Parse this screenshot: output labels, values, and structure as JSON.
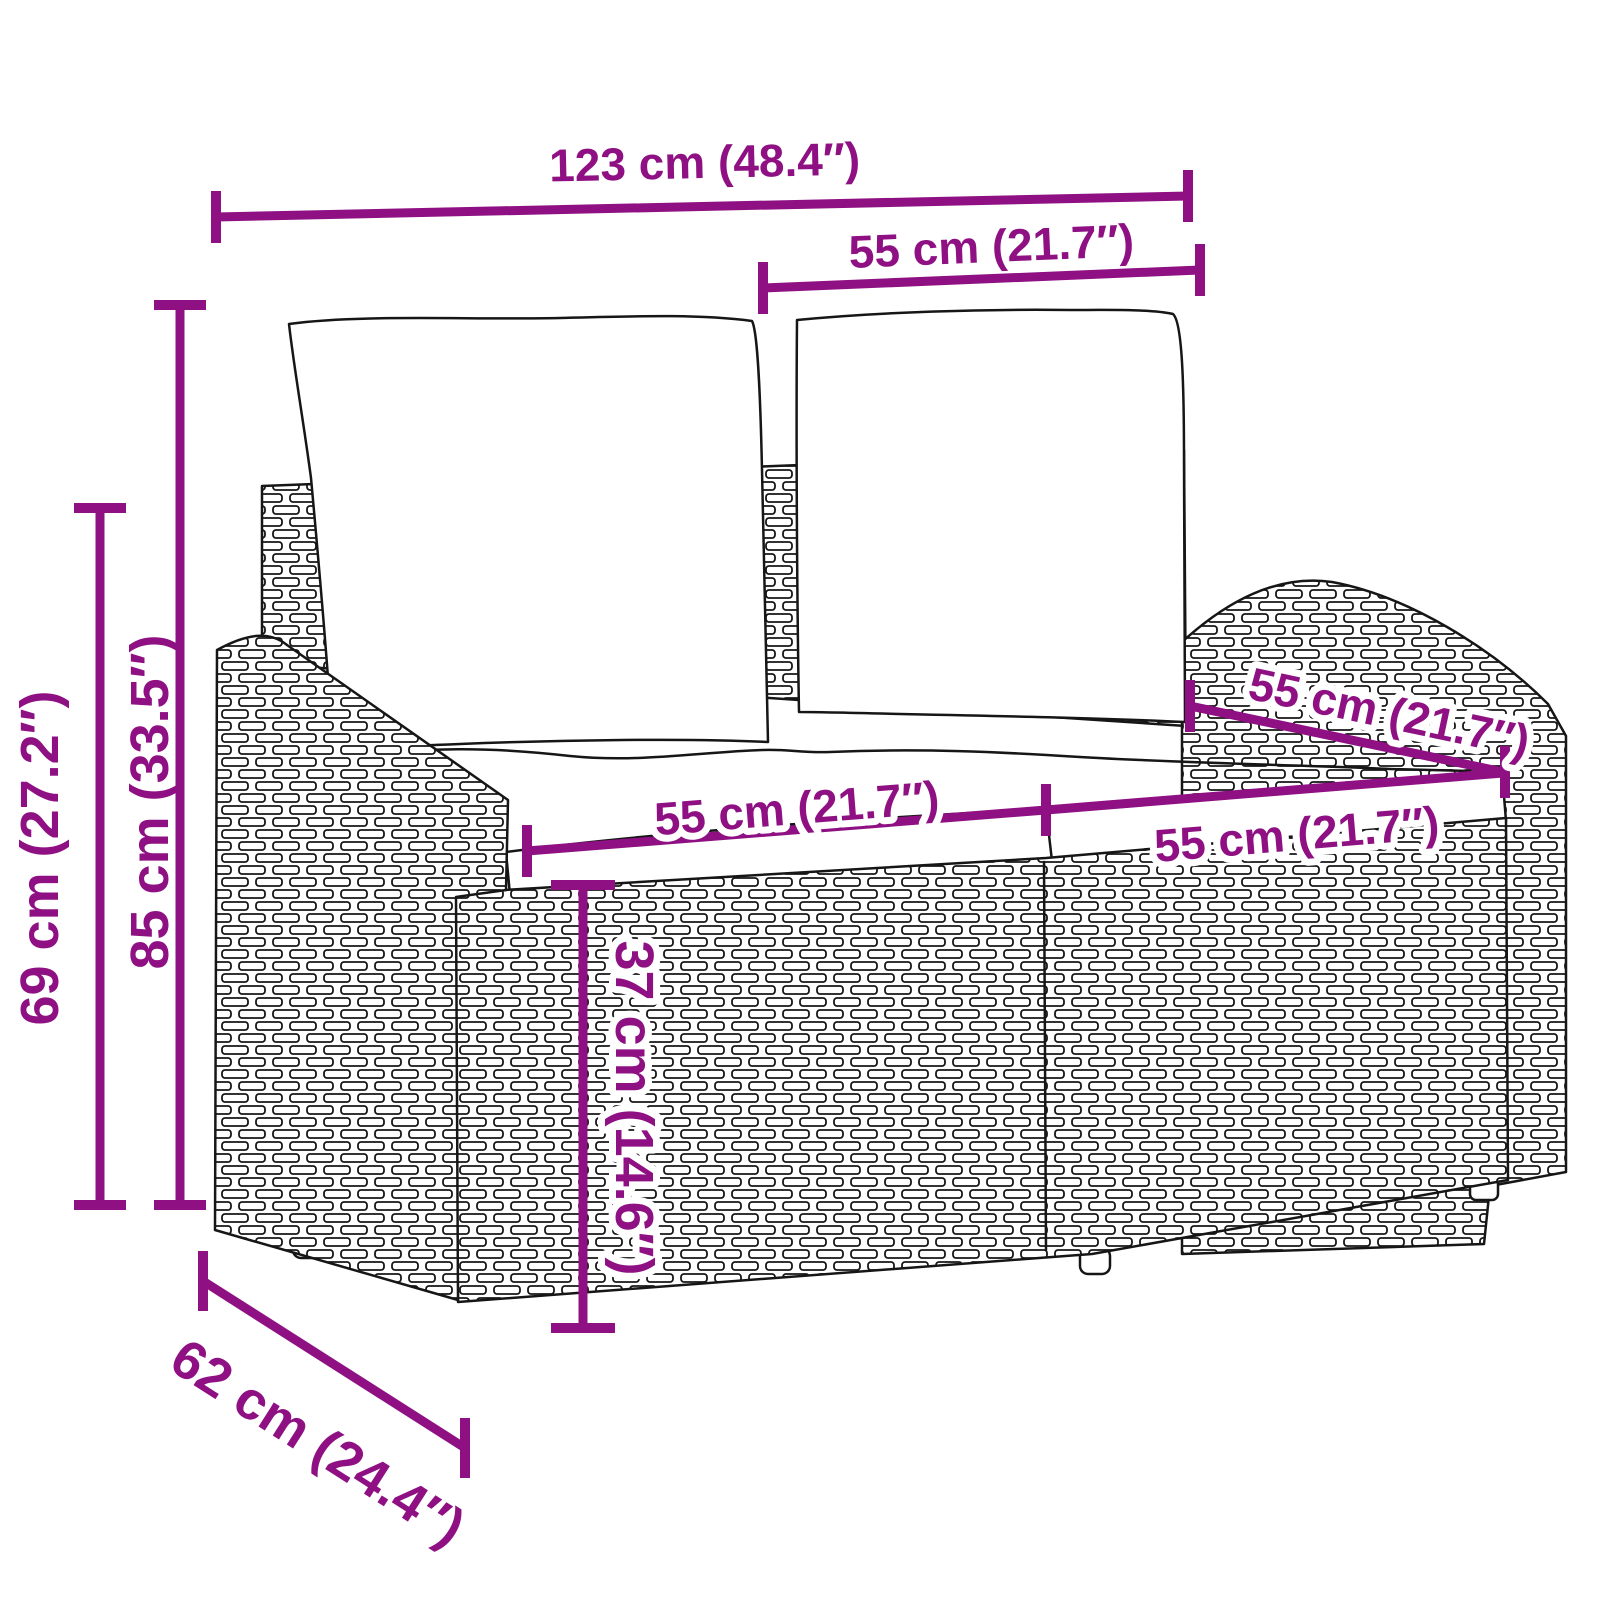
{
  "diagram": {
    "kind": "furniture dimension diagram",
    "subject": "rattan 2-seater garden bench with back and seat cushions"
  },
  "style": {
    "dimension_color": "#8E1083",
    "artwork_line_color": "#161616",
    "background": "#FFFFFF"
  },
  "dims": {
    "overall_width": {
      "label": "123 cm (48.4″)",
      "value_cm": 123,
      "value_inch": 48.4
    },
    "back_width": {
      "label": "55 cm (21.7″)",
      "value_cm": 55,
      "value_inch": 21.7
    },
    "height_outer": {
      "label": "69 cm (27.2″)",
      "value_cm": 69,
      "value_inch": 27.2
    },
    "height_total": {
      "label": "85 cm (33.5″)",
      "value_cm": 85,
      "value_inch": 33.5
    },
    "seat_width_left": {
      "label": "55 cm (21.7″)",
      "value_cm": 55,
      "value_inch": 21.7
    },
    "seat_width_right": {
      "label": "55 cm (21.7″)",
      "value_cm": 55,
      "value_inch": 21.7
    },
    "seat_depth_right": {
      "label": "55 cm (21.7″)",
      "value_cm": 55,
      "value_inch": 21.7
    },
    "seat_height": {
      "label": "37 cm (14.6″)",
      "value_cm": 37,
      "value_inch": 14.6
    },
    "base_depth": {
      "label": "62 cm (24.4″)",
      "value_cm": 62,
      "value_inch": 24.4
    }
  }
}
